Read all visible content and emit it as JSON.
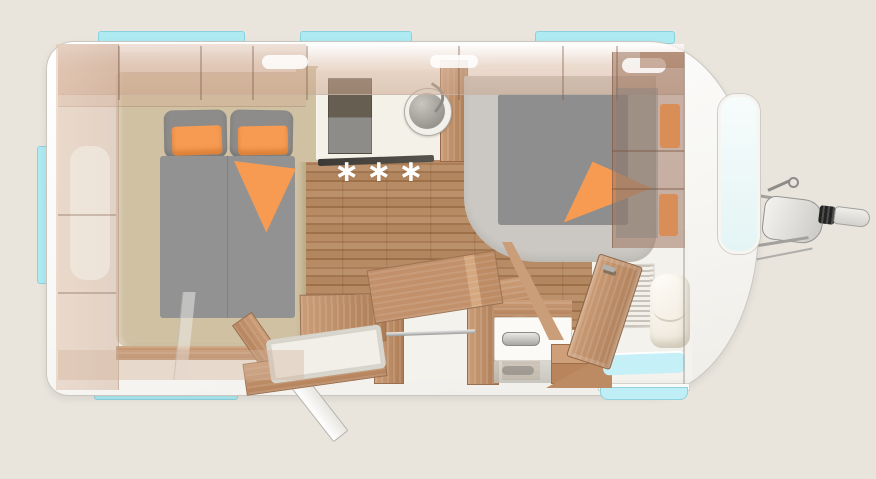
{
  "scene": {
    "name": "caravan floor plan top view",
    "background_color": "#e9e5dd"
  },
  "palette": {
    "body_white": "#fbfaf8",
    "outline_gray": "#c9c6bf",
    "window_cyan": "#aeeaf2",
    "front_window_glow": "#eaf6f6",
    "wood_floor": "#b2865f",
    "furniture_wood": "#c2916b",
    "bed_base_beige": "#cfc1a2",
    "mattress_gray": "#8e8e8e",
    "front_platform_gray": "#cbc8c3",
    "accent_orange": "#f79b52",
    "ivory_floor": "#f4f2ec"
  },
  "kitchen": {
    "floor_marks": "∗∗∗"
  },
  "rear_bedroom": {
    "pillow_count": 2,
    "orange_cushion_count": 2,
    "blanket_folds": 1
  },
  "front_bedroom": {
    "orange_cushion_count": 2,
    "blanket_folds": 1
  },
  "windows": {
    "top_strip_count": 3,
    "left_strip_count": 1,
    "bottom_strip_count": 2,
    "front_window_count": 1
  }
}
